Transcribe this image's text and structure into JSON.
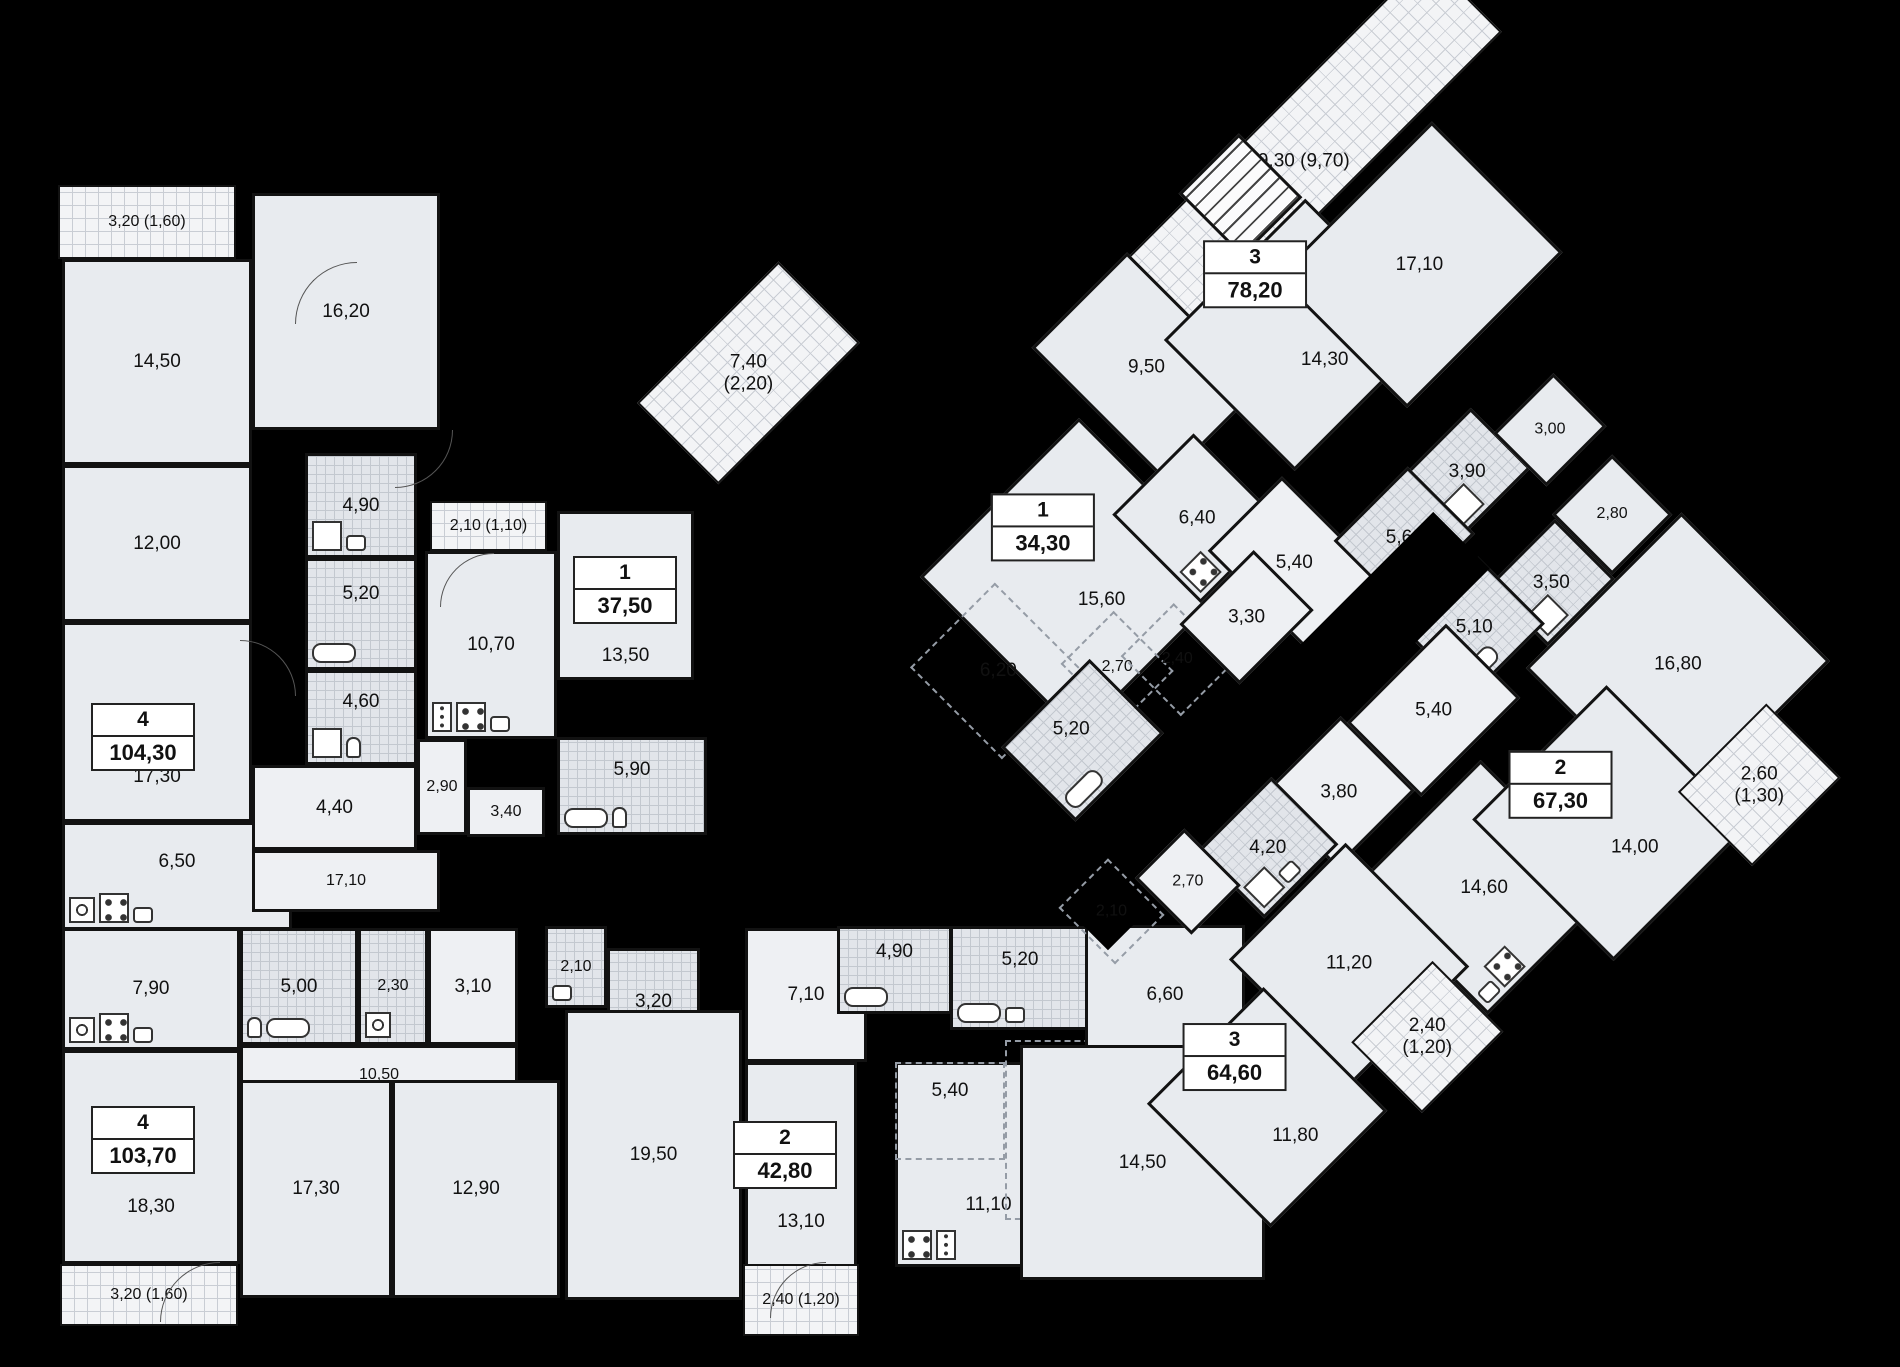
{
  "title": "residential-floor-plan",
  "colors": {
    "background": "#000000",
    "room_fill": "#e8ebef",
    "bath_fill": "#e2e5ea",
    "balcony_fill": "#f3f4f6",
    "wall": "#121212",
    "text": "#111111"
  },
  "apartments_summary": [
    {
      "rooms": "4",
      "area": "104,30"
    },
    {
      "rooms": "1",
      "area": "37,50"
    },
    {
      "rooms": "4",
      "area": "103,70"
    },
    {
      "rooms": "2",
      "area": "42,80"
    },
    {
      "rooms": "3",
      "area": "78,20"
    },
    {
      "rooms": "1",
      "area": "34,30"
    },
    {
      "rooms": "2",
      "area": "67,30"
    },
    {
      "rooms": "3",
      "area": "64,60"
    }
  ],
  "left_wing": {
    "rooms": [
      {
        "n": "balcony-3-20-top",
        "t": "hatch",
        "label": "3,20 (1,60)",
        "x": 58,
        "y": 185,
        "w": 178,
        "h": 74
      },
      {
        "n": "room-14-50",
        "t": "room",
        "label": "14,50",
        "x": 62,
        "y": 259,
        "w": 190,
        "h": 206
      },
      {
        "n": "room-12-00",
        "t": "room",
        "label": "12,00",
        "x": 62,
        "y": 465,
        "w": 190,
        "h": 157
      },
      {
        "n": "room-16-20",
        "t": "room",
        "label": "16,20",
        "x": 252,
        "y": 193,
        "w": 188,
        "h": 237
      },
      {
        "n": "room-17-30",
        "t": "room",
        "label": "17,30",
        "lyo": 55,
        "x": 62,
        "y": 622,
        "w": 190,
        "h": 200
      },
      {
        "n": "kitchen-6-50",
        "t": "room",
        "label": "6,50",
        "lyo": -14,
        "x": 62,
        "y": 822,
        "w": 230,
        "h": 108,
        "fx": [
          "washer",
          "stove",
          "sink"
        ]
      },
      {
        "n": "bath-4-90",
        "t": "tile",
        "label": "4,90",
        "x": 305,
        "y": 453,
        "w": 112,
        "h": 105,
        "fx": [
          "shower",
          "sink"
        ]
      },
      {
        "n": "bath-5-20",
        "t": "tile",
        "label": "5,20",
        "lyo": -20,
        "x": 305,
        "y": 558,
        "w": 112,
        "h": 112,
        "fx": [
          "tub"
        ]
      },
      {
        "n": "bath-4-60",
        "t": "tile",
        "label": "4,60",
        "lyo": -16,
        "x": 305,
        "y": 670,
        "w": 112,
        "h": 95,
        "fx": [
          "shower",
          "toilet"
        ]
      },
      {
        "n": "hall-4-40",
        "t": "hall",
        "label": "4,40",
        "x": 252,
        "y": 765,
        "w": 165,
        "h": 85
      },
      {
        "n": "hall-17-10",
        "t": "hall",
        "label": "17,10",
        "x": 252,
        "y": 850,
        "w": 188,
        "h": 62
      },
      {
        "n": "balcony-2-10",
        "t": "hatch",
        "label": "2,10 (1,10)",
        "x": 430,
        "y": 501,
        "w": 117,
        "h": 50
      },
      {
        "n": "kitchen-10-70",
        "t": "room",
        "label": "10,70",
        "x": 425,
        "y": 551,
        "w": 132,
        "h": 188,
        "fx": [
          "fridge",
          "stove",
          "sink"
        ]
      },
      {
        "n": "room-13-50",
        "t": "room",
        "label": "13,50",
        "lyo": 60,
        "x": 557,
        "y": 511,
        "w": 137,
        "h": 169
      },
      {
        "n": "hall-2-90",
        "t": "hall",
        "label": "2,90",
        "x": 417,
        "y": 739,
        "w": 50,
        "h": 96
      },
      {
        "n": "hall-3-40",
        "t": "hall",
        "label": "3,40",
        "x": 467,
        "y": 787,
        "w": 78,
        "h": 50
      },
      {
        "n": "bath-5-90",
        "t": "tile",
        "label": "5,90",
        "lyo": -16,
        "x": 557,
        "y": 737,
        "w": 150,
        "h": 98,
        "fx": [
          "tub",
          "toilet"
        ]
      },
      {
        "n": "kitchen-7-90",
        "t": "room",
        "label": "7,90",
        "x": 62,
        "y": 928,
        "w": 178,
        "h": 122,
        "fx": [
          "washer",
          "stove",
          "sink"
        ]
      },
      {
        "n": "bath-5-00",
        "t": "tile",
        "label": "5,00",
        "x": 240,
        "y": 928,
        "w": 118,
        "h": 117,
        "fx": [
          "toilet",
          "tub"
        ]
      },
      {
        "n": "bath-2-30",
        "t": "tile",
        "label": "2,30",
        "x": 358,
        "y": 928,
        "w": 70,
        "h": 117,
        "fx": [
          "washer"
        ]
      },
      {
        "n": "hall-3-10",
        "t": "hall",
        "label": "3,10",
        "x": 428,
        "y": 928,
        "w": 90,
        "h": 117
      },
      {
        "n": "hall-10-50",
        "t": "hall",
        "label": "10,50",
        "x": 240,
        "y": 1045,
        "w": 278,
        "h": 60
      },
      {
        "n": "wc-2-10",
        "t": "tile",
        "label": "2,10",
        "x": 545,
        "y": 926,
        "w": 62,
        "h": 82,
        "fx": [
          "sink"
        ]
      },
      {
        "n": "bath-3-20",
        "t": "tile",
        "label": "3,20",
        "x": 607,
        "y": 948,
        "w": 93,
        "h": 107,
        "fx": [
          "shower",
          "toilet"
        ]
      },
      {
        "n": "room-18-30",
        "t": "room",
        "label": "18,30",
        "lyo": 50,
        "x": 62,
        "y": 1050,
        "w": 178,
        "h": 214
      },
      {
        "n": "room-17-30-b",
        "t": "room",
        "label": "17,30",
        "x": 240,
        "y": 1080,
        "w": 152,
        "h": 218
      },
      {
        "n": "room-12-90",
        "t": "room",
        "label": "12,90",
        "x": 392,
        "y": 1080,
        "w": 168,
        "h": 218
      },
      {
        "n": "room-19-50",
        "t": "room",
        "label": "19,50",
        "x": 565,
        "y": 1010,
        "w": 177,
        "h": 290
      },
      {
        "n": "balcony-3-20-bottom",
        "t": "hatch",
        "label": "3,20 (1,60)",
        "x": 60,
        "y": 1264,
        "w": 178,
        "h": 62
      },
      {
        "n": "hall-7-10",
        "t": "hall",
        "label": "7,10",
        "x": 745,
        "y": 928,
        "w": 122,
        "h": 134
      },
      {
        "n": "bath-4-90-b",
        "t": "tile",
        "label": "4,90",
        "lyo": -18,
        "x": 837,
        "y": 926,
        "w": 115,
        "h": 88,
        "fx": [
          "tub"
        ]
      },
      {
        "n": "bath-5-20-b",
        "t": "tile",
        "label": "5,20",
        "lyo": -18,
        "x": 950,
        "y": 926,
        "w": 140,
        "h": 104,
        "fx": [
          "tub",
          "sink"
        ]
      },
      {
        "n": "room-13-10",
        "t": "room",
        "label": "13,10",
        "lyo": 45,
        "x": 745,
        "y": 1062,
        "w": 112,
        "h": 230
      },
      {
        "n": "kitchen-11-10",
        "t": "room",
        "label": "11,10",
        "lyo": 40,
        "x": 895,
        "y": 1062,
        "w": 187,
        "h": 205,
        "fx": [
          "stove",
          "fridge"
        ]
      },
      {
        "n": "zone-5-40",
        "t": "zone",
        "label": "5,40",
        "lyo": -20,
        "x": 895,
        "y": 1062,
        "w": 110,
        "h": 98
      },
      {
        "n": "zone-5-10",
        "t": "zone",
        "label": "5,10",
        "lyo": -20,
        "x": 1005,
        "y": 1040,
        "w": 135,
        "h": 180
      },
      {
        "n": "room-6-60",
        "t": "room",
        "label": "6,60",
        "x": 1085,
        "y": 925,
        "w": 160,
        "h": 140
      },
      {
        "n": "room-14-50-b",
        "t": "room",
        "label": "14,50",
        "x": 1020,
        "y": 1045,
        "w": 245,
        "h": 235
      },
      {
        "n": "balcony-2-40-bottom",
        "t": "hatch",
        "label": "2,40 (1,20)",
        "x": 743,
        "y": 1264,
        "w": 116,
        "h": 72
      }
    ],
    "badges": [
      {
        "n": "badge-apt-104-30",
        "rooms": "4",
        "area": "104,30",
        "cx": 143,
        "cy": 737
      },
      {
        "n": "badge-apt-37-50",
        "rooms": "1",
        "area": "37,50",
        "cx": 625,
        "cy": 590
      },
      {
        "n": "badge-apt-103-70",
        "rooms": "4",
        "area": "103,70",
        "cx": 143,
        "cy": 1140
      },
      {
        "n": "badge-apt-42-80",
        "rooms": "2",
        "area": "42,80",
        "cx": 785,
        "cy": 1155
      }
    ],
    "doors": [
      {
        "x": 295,
        "y": 262,
        "s": 62,
        "r": 0
      },
      {
        "x": 395,
        "y": 430,
        "s": 58,
        "r": 180
      },
      {
        "x": 440,
        "y": 553,
        "s": 54,
        "r": 0
      },
      {
        "x": 160,
        "y": 1262,
        "s": 60,
        "r": 0
      },
      {
        "x": 770,
        "y": 1262,
        "s": 56,
        "r": 0
      },
      {
        "x": 240,
        "y": 640,
        "s": 56,
        "r": 90
      }
    ]
  },
  "right_wing": {
    "left": 514,
    "top": 526,
    "rotation_deg": -45,
    "width": 1060,
    "height": 1120,
    "rooms": [
      {
        "n": "terrace-19-30",
        "t": "hatch",
        "label": "19,30 (9,70)",
        "x": 578,
        "y": 244,
        "w": 470,
        "h": 105
      },
      {
        "n": "balcony-7-40",
        "t": "hatch",
        "label": "7,40",
        "label2": "(2,20)",
        "x": 174,
        "y": 0,
        "w": 200,
        "h": 115
      },
      {
        "n": "room-9-50",
        "t": "room",
        "label": "9,50",
        "x": 492,
        "y": 240,
        "w": 135,
        "h": 190
      },
      {
        "n": "room-14-30",
        "t": "room",
        "label": "14,30",
        "lyo": 35,
        "x": 591,
        "y": 328,
        "w": 200,
        "h": 185
      },
      {
        "n": "stairwell",
        "t": "stairs",
        "x": 705,
        "y": 235,
        "w": 85,
        "h": 90
      },
      {
        "n": "room-17-10-r",
        "t": "room",
        "label": "17,10",
        "x": 715,
        "y": 363,
        "w": 220,
        "h": 185
      },
      {
        "n": "room-15-60",
        "t": "room",
        "label": "15,60",
        "lyo": 32,
        "x": 251,
        "y": 323,
        "w": 225,
        "h": 225
      },
      {
        "n": "zone-6-20",
        "t": "zone",
        "label": "6,20",
        "x": 180,
        "y": 380,
        "w": 120,
        "h": 130
      },
      {
        "n": "zone-2-70-a1",
        "t": "zone",
        "label": "2,70",
        "x": 289,
        "y": 484,
        "w": 75,
        "h": 85
      },
      {
        "n": "zone-2-40-a1",
        "t": "zone",
        "label": "2,40",
        "x": 337,
        "y": 521,
        "w": 75,
        "h": 85
      },
      {
        "n": "bath-5-20-a1",
        "t": "tile",
        "label": "5,20",
        "lyo": -16,
        "x": 188,
        "y": 501,
        "w": 125,
        "h": 105,
        "fx": [
          "tub"
        ]
      },
      {
        "n": "kitchen-6-40",
        "t": "room",
        "label": "6,40",
        "x": 431,
        "y": 415,
        "w": 115,
        "h": 125,
        "fx": [
          "stove"
        ]
      },
      {
        "n": "hall-5-40-u",
        "t": "hall",
        "label": "5,40",
        "x": 473,
        "y": 508,
        "w": 105,
        "h": 140
      },
      {
        "n": "hall-3-30",
        "t": "hall",
        "label": "3,30",
        "x": 401,
        "y": 540,
        "w": 105,
        "h": 85
      },
      {
        "n": "bath-3-90",
        "t": "tile",
        "label": "3,90",
        "x": 665,
        "y": 593,
        "w": 95,
        "h": 85,
        "fx": [
          "shower"
        ]
      },
      {
        "n": "room-3-00",
        "t": "room",
        "label": "3,00",
        "x": 758,
        "y": 627,
        "w": 85,
        "h": 75
      },
      {
        "n": "bath-5-60",
        "t": "tile",
        "label": "5,60",
        "x": 569,
        "y": 590,
        "w": 105,
        "h": 95,
        "fx": [
          "tub"
        ]
      },
      {
        "n": "room-2-80",
        "t": "room",
        "label": "2,80",
        "x": 742,
        "y": 726,
        "w": 85,
        "h": 85
      },
      {
        "n": "bath-3-50",
        "t": "tile",
        "label": "3,50",
        "x": 646,
        "y": 731,
        "w": 95,
        "h": 85,
        "fx": [
          "shower"
        ]
      },
      {
        "n": "bath-5-10",
        "t": "tile",
        "label": "5,10",
        "x": 555,
        "y": 703,
        "w": 105,
        "h": 95,
        "fx": [
          "tub"
        ]
      },
      {
        "n": "room-16-80",
        "t": "room",
        "label": "16,80",
        "x": 615,
        "y": 816,
        "w": 220,
        "h": 210
      },
      {
        "n": "corridor-core",
        "t": "void",
        "x": 120,
        "y": 640,
        "w": 540,
        "h": 80
      },
      {
        "n": "hall-5-40-l",
        "t": "hall",
        "label": "5,40",
        "x": 450,
        "y": 728,
        "w": 140,
        "h": 105
      },
      {
        "n": "hall-3-80",
        "t": "hall",
        "label": "3,80",
        "x": 340,
        "y": 719,
        "w": 110,
        "h": 105
      },
      {
        "n": "bath-4-20",
        "t": "tile",
        "label": "4,20",
        "x": 253,
        "y": 713,
        "w": 105,
        "h": 95,
        "fx": [
          "shower",
          "sink"
        ]
      },
      {
        "n": "hall-2-70-a3",
        "t": "hall",
        "label": "2,70",
        "x": 190,
        "y": 688,
        "w": 70,
        "h": 80
      },
      {
        "n": "zone-2-10-a3",
        "t": "zone",
        "label": "2,10",
        "x": 115,
        "y": 655,
        "w": 70,
        "h": 80
      },
      {
        "n": "kitchen-14-60",
        "t": "room",
        "label": "14,60",
        "x": 343,
        "y": 849,
        "w": 175,
        "h": 185,
        "fx": [
          "sink",
          "stove"
        ]
      },
      {
        "n": "room-14-00",
        "t": "room",
        "label": "14,00",
        "lyo": 35,
        "x": 470,
        "y": 885,
        "w": 190,
        "h": 200
      },
      {
        "n": "balcony-2-60",
        "t": "hatch",
        "label": "2,60",
        "label2": "(1,30)",
        "x": 635,
        "y": 1011,
        "w": 125,
        "h": 105
      },
      {
        "n": "room-11-20",
        "t": "room",
        "label": "11,20",
        "x": 199,
        "y": 812,
        "w": 165,
        "h": 175
      },
      {
        "n": "room-11-80",
        "t": "room",
        "label": "11,80",
        "lyo": 40,
        "x": 39,
        "y": 856,
        "w": 165,
        "h": 175
      },
      {
        "n": "balcony-2-40-r",
        "t": "hatch",
        "label": "2,40",
        "label2": "(1,20)",
        "x": 227,
        "y": 957,
        "w": 115,
        "h": 100
      }
    ],
    "badges": [
      {
        "n": "badge-apt-78-20",
        "rooms": "3",
        "area": "78,20",
        "cx": 702,
        "cy": 346
      },
      {
        "n": "badge-apt-34-30",
        "rooms": "1",
        "area": "34,30",
        "cx": 373,
        "cy": 375
      },
      {
        "n": "badge-apt-67-30",
        "rooms": "2",
        "area": "67,30",
        "cx": 557,
        "cy": 923
      },
      {
        "n": "badge-apt-64-60",
        "rooms": "3",
        "area": "64,60",
        "cx": 134,
        "cy": 885
      }
    ],
    "doors": []
  }
}
